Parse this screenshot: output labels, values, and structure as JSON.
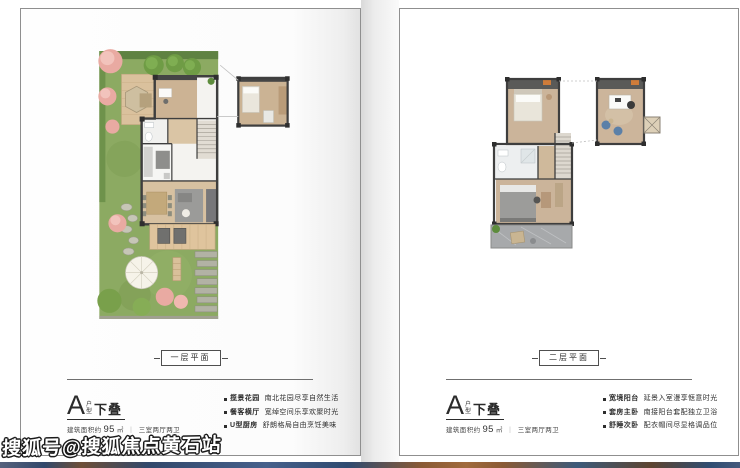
{
  "watermark": "搜狐号@搜狐焦点黄石站",
  "palette": {
    "card_border": "#8f8f8f",
    "lawn_green": "#8caa62",
    "wood_floor": "#ccb59b",
    "wall_dark": "#454545",
    "text_dark": "#2b2b2b",
    "strip_blue": "#2f4d72",
    "strip_brown": "#8a5a35",
    "pink_tree": "#e9aaa2",
    "blue_chair": "#5b80a8"
  },
  "pages": {
    "left": {
      "floor_badge": "一层平面",
      "unit": {
        "letter": "A",
        "type_vertical": [
          "户",
          "型"
        ],
        "suffix": "下叠"
      },
      "area": {
        "prefix": "建筑面积约",
        "value": "95",
        "unit": "㎡",
        "separator": "｜",
        "layout": "三室两厅两卫"
      },
      "bullets": [
        {
          "term": "揽景花园",
          "desc": "南北花园尽享自然生活"
        },
        {
          "term": "餐客横厅",
          "desc": "宽绰空间乐享欢聚时光"
        },
        {
          "term": "U型厨房",
          "desc": "舒朗格局自由烹饪美味"
        }
      ]
    },
    "right": {
      "floor_badge": "二层平面",
      "unit": {
        "letter": "A",
        "type_vertical": [
          "户",
          "型"
        ],
        "suffix": "下叠"
      },
      "area": {
        "prefix": "建筑面积约",
        "value": "95",
        "unit": "㎡",
        "separator": "｜",
        "layout": "三室两厅两卫"
      },
      "bullets": [
        {
          "term": "宽境阳台",
          "desc": "延景入室漫享惬意时光"
        },
        {
          "term": "套房主卧",
          "desc": "南接阳台套配独立卫浴"
        },
        {
          "term": "舒睡次卧",
          "desc": "配衣帽间尽显格调品位"
        }
      ]
    }
  }
}
